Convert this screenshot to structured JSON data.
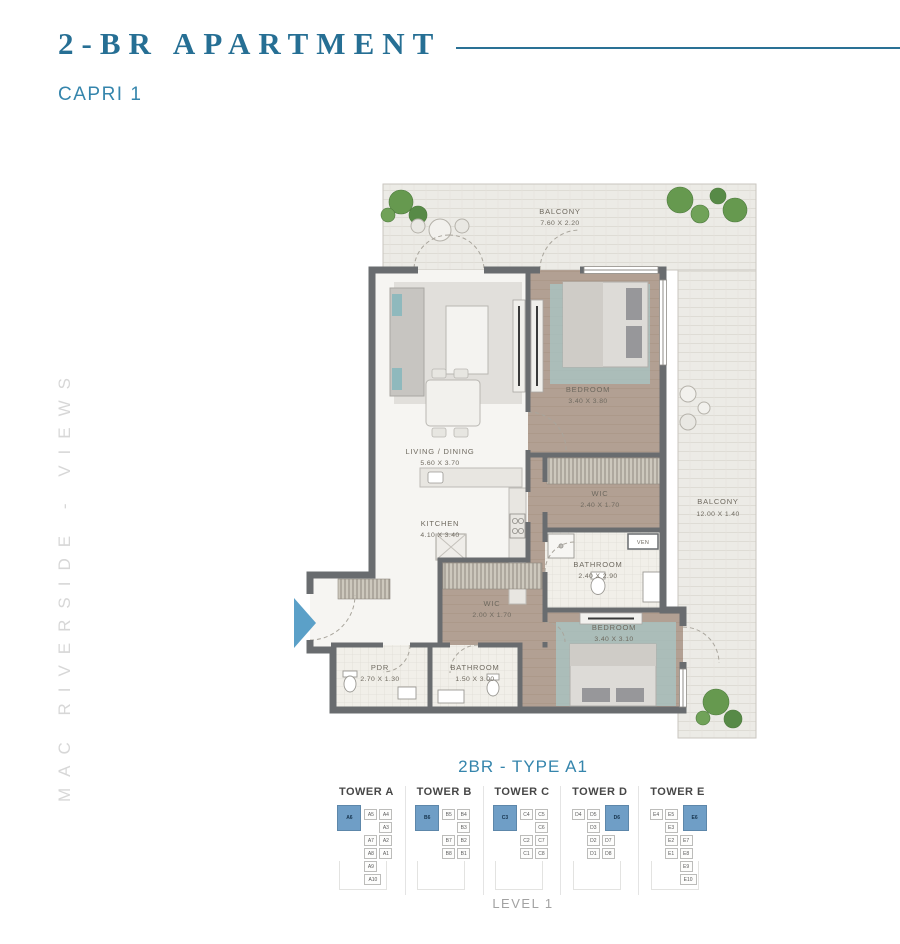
{
  "header": {
    "title": "2-BR APARTMENT",
    "subtitle": "CAPRI 1"
  },
  "side_text": "MAC RIVERSIDE - VIEWS",
  "floor_plan": {
    "balcony_top": {
      "name": "BALCONY",
      "dims": "7.60 X 2.20"
    },
    "balcony_right": {
      "name": "BALCONY",
      "dims": "12.00 X 1.40"
    },
    "rooms": [
      {
        "name": "BEDROOM",
        "dims": "3.40 X 3.80"
      },
      {
        "name": "WIC",
        "dims": "2.40 X 1.70"
      },
      {
        "name": "BATHROOM",
        "dims": "2.40 X 2.90"
      },
      {
        "name": "LIVING / DINING",
        "dims": "5.60 X 3.70"
      },
      {
        "name": "KITCHEN",
        "dims": "4.10 X 3.40"
      },
      {
        "name": "WIC",
        "dims": "2.00 X 1.70"
      },
      {
        "name": "BEDROOM",
        "dims": "3.40 X 3.10"
      },
      {
        "name": "BATHROOM",
        "dims": "1.50 X 3.00"
      },
      {
        "name": "PDR",
        "dims": "2.70 X 1.30"
      }
    ],
    "ven_label": "VEN"
  },
  "unit_type_label": "2BR - TYPE A1",
  "level_label": "LEVEL 1",
  "towers": [
    {
      "label": "TOWER A",
      "units": [
        {
          "label": "A6",
          "x": 2,
          "y": 2,
          "w": 24,
          "h": 26,
          "hl": true
        },
        {
          "label": "A5",
          "x": 29,
          "y": 6,
          "w": 13,
          "h": 11,
          "hl": false
        },
        {
          "label": "A4",
          "x": 44,
          "y": 6,
          "w": 13,
          "h": 11,
          "hl": false
        },
        {
          "label": "A3",
          "x": 44,
          "y": 19,
          "w": 13,
          "h": 11,
          "hl": false
        },
        {
          "label": "A7",
          "x": 29,
          "y": 32,
          "w": 13,
          "h": 11,
          "hl": false
        },
        {
          "label": "A2",
          "x": 44,
          "y": 32,
          "w": 13,
          "h": 11,
          "hl": false
        },
        {
          "label": "A8",
          "x": 29,
          "y": 45,
          "w": 13,
          "h": 11,
          "hl": false
        },
        {
          "label": "A1",
          "x": 44,
          "y": 45,
          "w": 13,
          "h": 11,
          "hl": false
        },
        {
          "label": "A9",
          "x": 29,
          "y": 58,
          "w": 13,
          "h": 11,
          "hl": false
        },
        {
          "label": "A10",
          "x": 29,
          "y": 71,
          "w": 17,
          "h": 11,
          "hl": false
        }
      ]
    },
    {
      "label": "TOWER B",
      "units": [
        {
          "label": "B6",
          "x": 2,
          "y": 2,
          "w": 24,
          "h": 26,
          "hl": true
        },
        {
          "label": "B5",
          "x": 29,
          "y": 6,
          "w": 13,
          "h": 11,
          "hl": false
        },
        {
          "label": "B4",
          "x": 44,
          "y": 6,
          "w": 13,
          "h": 11,
          "hl": false
        },
        {
          "label": "B3",
          "x": 44,
          "y": 19,
          "w": 13,
          "h": 11,
          "hl": false
        },
        {
          "label": "B7",
          "x": 29,
          "y": 32,
          "w": 13,
          "h": 11,
          "hl": false
        },
        {
          "label": "B2",
          "x": 44,
          "y": 32,
          "w": 13,
          "h": 11,
          "hl": false
        },
        {
          "label": "B8",
          "x": 29,
          "y": 45,
          "w": 13,
          "h": 11,
          "hl": false
        },
        {
          "label": "B1",
          "x": 44,
          "y": 45,
          "w": 13,
          "h": 11,
          "hl": false
        }
      ]
    },
    {
      "label": "TOWER C",
      "units": [
        {
          "label": "C3",
          "x": 2,
          "y": 2,
          "w": 24,
          "h": 26,
          "hl": true
        },
        {
          "label": "C4",
          "x": 29,
          "y": 6,
          "w": 13,
          "h": 11,
          "hl": false
        },
        {
          "label": "C5",
          "x": 44,
          "y": 6,
          "w": 13,
          "h": 11,
          "hl": false
        },
        {
          "label": "C6",
          "x": 44,
          "y": 19,
          "w": 13,
          "h": 11,
          "hl": false
        },
        {
          "label": "C2",
          "x": 29,
          "y": 32,
          "w": 13,
          "h": 11,
          "hl": false
        },
        {
          "label": "C7",
          "x": 44,
          "y": 32,
          "w": 13,
          "h": 11,
          "hl": false
        },
        {
          "label": "C1",
          "x": 29,
          "y": 45,
          "w": 13,
          "h": 11,
          "hl": false
        },
        {
          "label": "C8",
          "x": 44,
          "y": 45,
          "w": 13,
          "h": 11,
          "hl": false
        }
      ]
    },
    {
      "label": "TOWER D",
      "units": [
        {
          "label": "D4",
          "x": 3,
          "y": 6,
          "w": 13,
          "h": 11,
          "hl": false
        },
        {
          "label": "D5",
          "x": 18,
          "y": 6,
          "w": 13,
          "h": 11,
          "hl": false
        },
        {
          "label": "D6",
          "x": 36,
          "y": 2,
          "w": 24,
          "h": 26,
          "hl": true
        },
        {
          "label": "D3",
          "x": 18,
          "y": 19,
          "w": 13,
          "h": 11,
          "hl": false
        },
        {
          "label": "D2",
          "x": 18,
          "y": 32,
          "w": 13,
          "h": 11,
          "hl": false
        },
        {
          "label": "D7",
          "x": 33,
          "y": 32,
          "w": 13,
          "h": 11,
          "hl": false
        },
        {
          "label": "D1",
          "x": 18,
          "y": 45,
          "w": 13,
          "h": 11,
          "hl": false
        },
        {
          "label": "D8",
          "x": 33,
          "y": 45,
          "w": 13,
          "h": 11,
          "hl": false
        }
      ]
    },
    {
      "label": "TOWER E",
      "units": [
        {
          "label": "E4",
          "x": 3,
          "y": 6,
          "w": 13,
          "h": 11,
          "hl": false
        },
        {
          "label": "E5",
          "x": 18,
          "y": 6,
          "w": 13,
          "h": 11,
          "hl": false
        },
        {
          "label": "E6",
          "x": 36,
          "y": 2,
          "w": 24,
          "h": 26,
          "hl": true
        },
        {
          "label": "E3",
          "x": 18,
          "y": 19,
          "w": 13,
          "h": 11,
          "hl": false
        },
        {
          "label": "E2",
          "x": 18,
          "y": 32,
          "w": 13,
          "h": 11,
          "hl": false
        },
        {
          "label": "E7",
          "x": 33,
          "y": 32,
          "w": 13,
          "h": 11,
          "hl": false
        },
        {
          "label": "E1",
          "x": 18,
          "y": 45,
          "w": 13,
          "h": 11,
          "hl": false
        },
        {
          "label": "E8",
          "x": 33,
          "y": 45,
          "w": 13,
          "h": 11,
          "hl": false
        },
        {
          "label": "E9",
          "x": 33,
          "y": 58,
          "w": 13,
          "h": 11,
          "hl": false
        },
        {
          "label": "E10",
          "x": 33,
          "y": 71,
          "w": 17,
          "h": 11,
          "hl": false
        }
      ]
    }
  ],
  "colors": {
    "accent_teal": "#2a7195",
    "subtitle_teal": "#3585ac",
    "highlight_blue": "#6f9ec6",
    "wall_gray": "#696c6f",
    "entry_arrow_blue": "#5ba0c8"
  }
}
